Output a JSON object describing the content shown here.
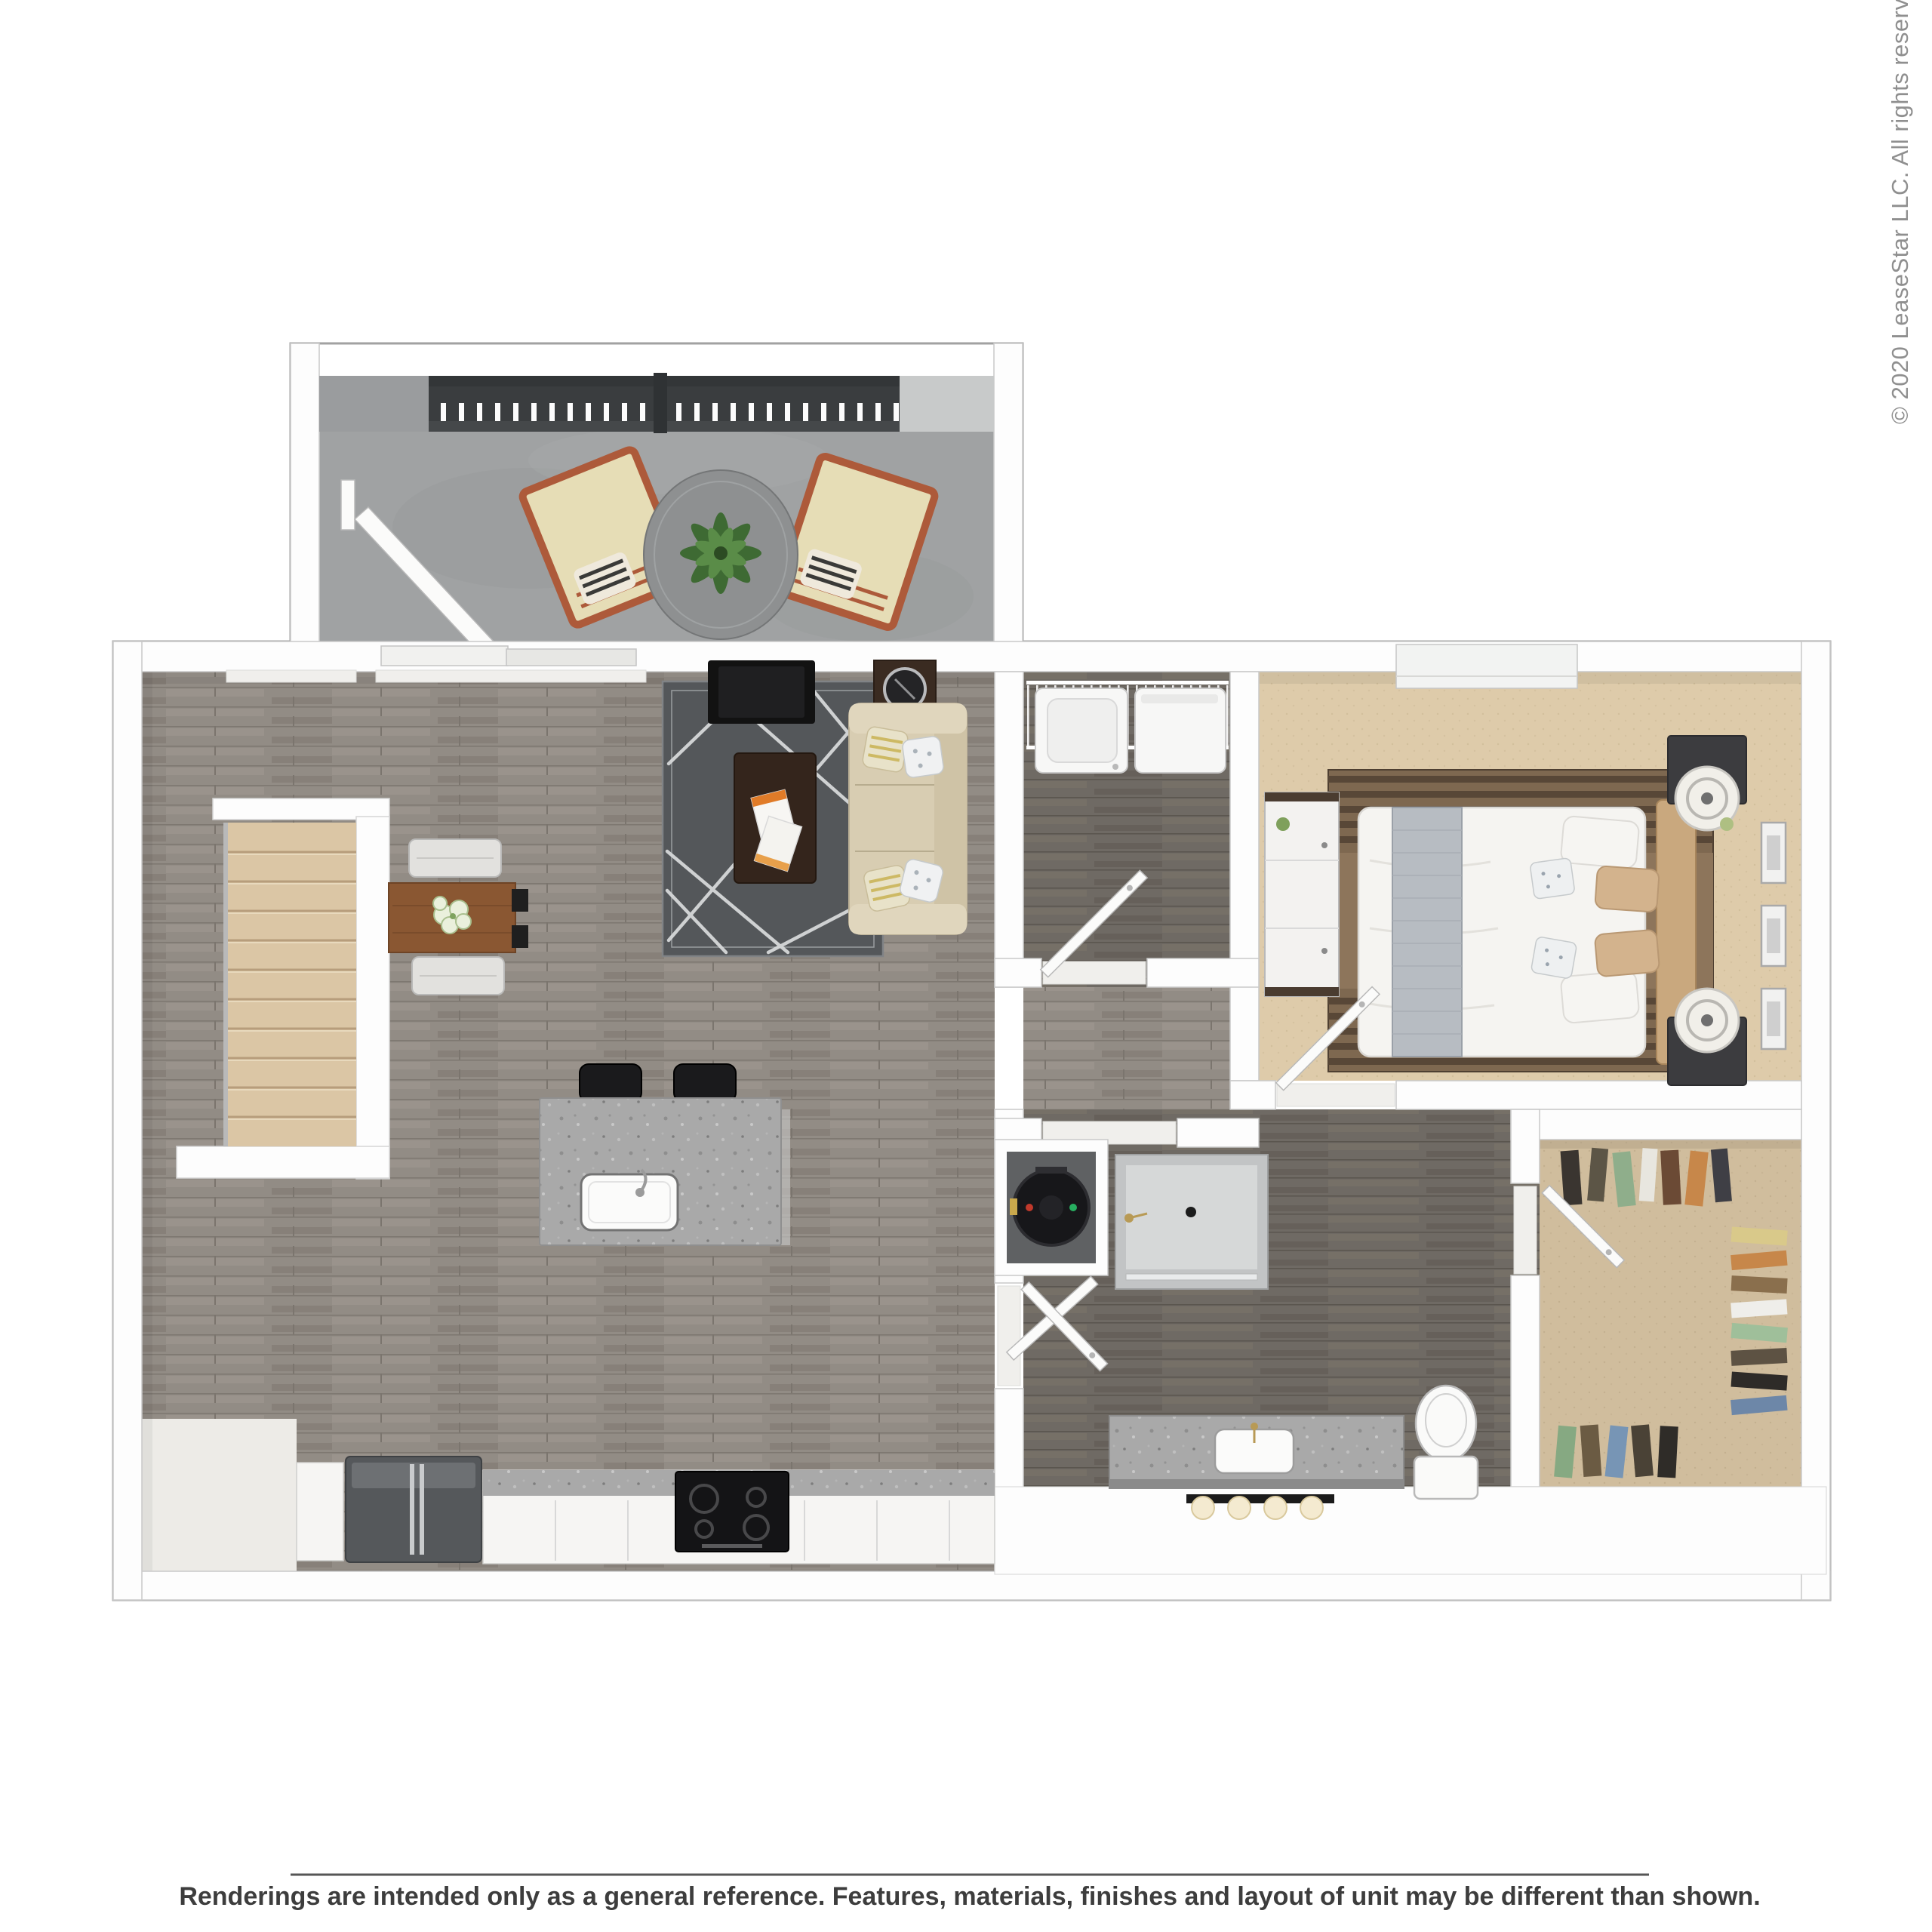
{
  "image": {
    "kind": "3d-floor-plan-rendering",
    "view": "top-down",
    "unit": "1 bedroom / 1 bathroom apartment with balcony and stairs"
  },
  "watermark": {
    "text": "© 2020 LeaseStar LLC. All rights reserved.",
    "color": "#8f8f8f",
    "orientation": "vertical-bottom-to-top"
  },
  "footer": {
    "disclaimer": "Renderings are intended only as a general reference. Features, materials, finishes and layout of unit may be different than shown.",
    "divider_color": "#565656",
    "text_color": "#3d3d3d"
  },
  "palette": {
    "wall": "#fdfdfd",
    "wall_outline": "#a2a2a2",
    "wood_floor": "#928c85",
    "wood_floor_dark": "#6f6a64",
    "balcony_concrete": "#a0a2a3",
    "railing_dark": "#3a3d3f",
    "bedroom_carpet": "#decbaa",
    "closet_carpet": "#d0bd9d",
    "stair_carpet": "#dbc6a5",
    "living_rug": "#54575a",
    "bedroom_rug": "#7e6850",
    "sofa_beige": "#d8cdb2",
    "dining_table_wood": "#8a5732",
    "granite": "#a9a9a9",
    "appliance_black": "#141416",
    "steel": "#55585b"
  },
  "rooms": [
    {
      "name": "balcony",
      "furniture": [
        "lounge-chair",
        "lounge-chair",
        "round-glass-table",
        "potted-plant",
        "railing",
        "open-door"
      ]
    },
    {
      "name": "living-room",
      "furniture": [
        "sofa",
        "throw-pillows",
        "geometric-area-rug",
        "coffee-table",
        "magazines",
        "tv",
        "side-table",
        "fan-ornament",
        "sliding-glass-door"
      ]
    },
    {
      "name": "dining-area",
      "furniture": [
        "dining-table",
        "floral-centerpiece",
        "bench",
        "bench",
        "black-chairs"
      ]
    },
    {
      "name": "kitchen",
      "furniture": [
        "island-with-sink",
        "bar-stool",
        "bar-stool",
        "refrigerator",
        "range-cooktop",
        "base-cabinets",
        "granite-counter"
      ]
    },
    {
      "name": "stairs",
      "furniture": [
        "carpeted-steps",
        "handrail"
      ]
    },
    {
      "name": "entry",
      "furniture": []
    },
    {
      "name": "laundry-closet",
      "furniture": [
        "wire-shelf",
        "washer",
        "dryer",
        "door"
      ]
    },
    {
      "name": "hallway",
      "furniture": [
        "doorways"
      ]
    },
    {
      "name": "water-heater-closet",
      "furniture": [
        "water-heater",
        "door"
      ]
    },
    {
      "name": "bathroom",
      "furniture": [
        "shower",
        "granite-vanity",
        "sink",
        "vanity-lights",
        "toilet",
        "door"
      ]
    },
    {
      "name": "bedroom",
      "furniture": [
        "queen-bed",
        "headboard",
        "gray-runner",
        "accent-pillows",
        "striped-rug",
        "nightstand",
        "nightstand",
        "table-lamp",
        "table-lamp",
        "dresser",
        "wall-frames",
        "window",
        "door"
      ]
    },
    {
      "name": "walk-in-closet",
      "furniture": [
        "hanging-clothes",
        "door"
      ]
    }
  ]
}
